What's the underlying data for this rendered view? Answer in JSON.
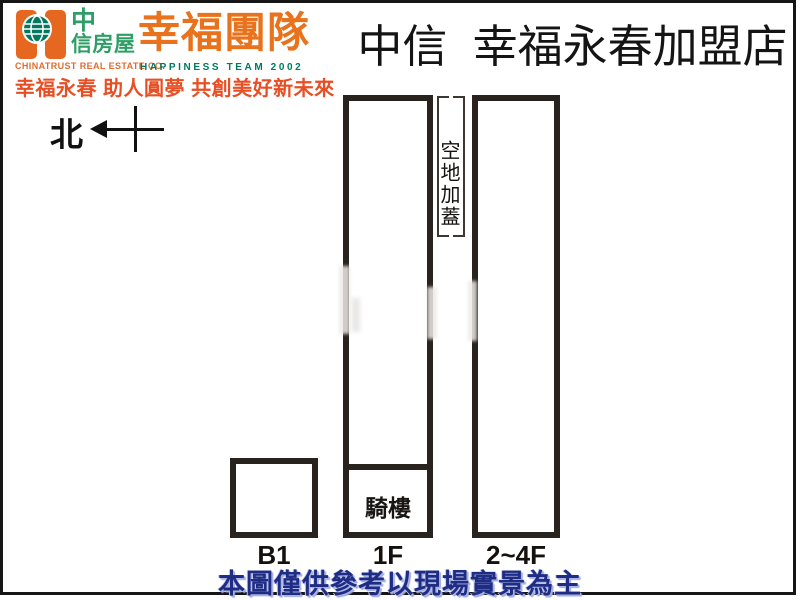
{
  "header": {
    "logo": {
      "brand_cn_line1": "中",
      "brand_cn_line2": "信房屋",
      "brand_en": "CHINATRUST REAL ESTATE CO.",
      "team_cn": "幸福團隊",
      "team_en": "HAPPINESS TEAM 2002",
      "tagline": "幸福永春 助人圓夢 共創美好新未來",
      "colors": {
        "brand_orange": "#e6671f",
        "brand_green": "#2e9e66",
        "brand_teal": "#00795f",
        "tagline_red": "#e84f24"
      }
    },
    "title": "中信 幸福永春加盟店"
  },
  "compass": {
    "north_label": "北"
  },
  "diagram": {
    "open_space_label": "空地加蓋",
    "buildings": [
      {
        "label": "B1"
      },
      {
        "label": "1F",
        "inner_label": "騎樓"
      },
      {
        "label": "2~4F"
      }
    ],
    "line_color": "#29231f"
  },
  "footer": {
    "notice": "本圖僅供參考以現場實景為主",
    "notice_color": "#1f2c84"
  }
}
